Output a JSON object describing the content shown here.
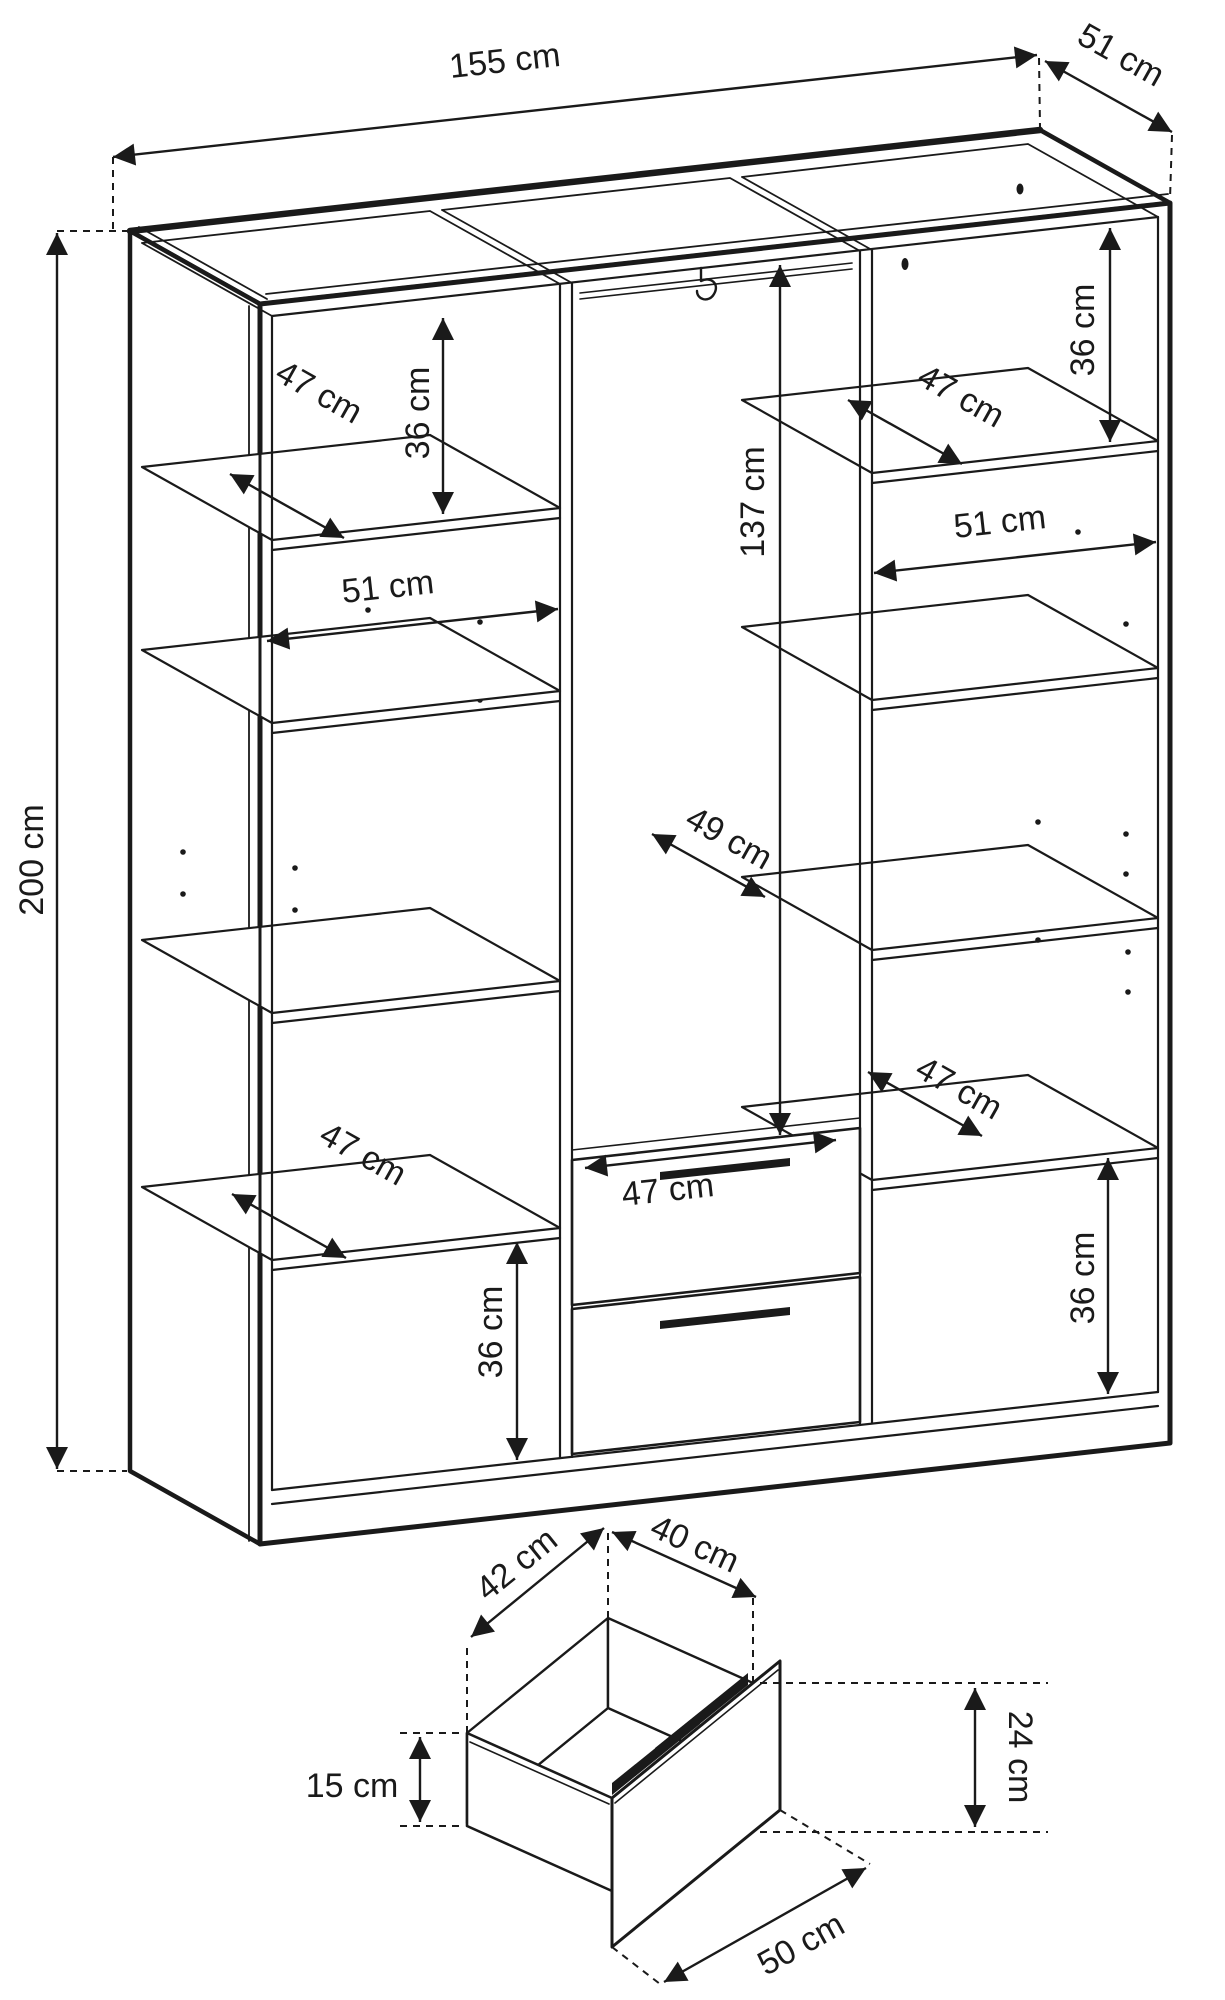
{
  "drawing": {
    "overall": {
      "width": "155 cm",
      "depth": "51 cm",
      "height": "200 cm"
    },
    "left": {
      "top_gap": "36 cm",
      "top_shelf_depth": "47 cm",
      "width": "51 cm",
      "bottom_shelf_depth": "47 cm",
      "bottom_gap": "36 cm"
    },
    "middle": {
      "height": "137 cm",
      "depth": "49 cm",
      "width": "47 cm"
    },
    "right": {
      "top_shelf_depth": "47 cm",
      "top_gap": "36 cm",
      "width": "51 cm",
      "bottom_shelf_depth": "47 cm",
      "bottom_gap": "36 cm"
    },
    "drawer": {
      "top_inner_depth": "42 cm",
      "top_inner_width": "40 cm",
      "side_height": "15 cm",
      "front_height": "24 cm",
      "front_width": "50 cm"
    }
  }
}
